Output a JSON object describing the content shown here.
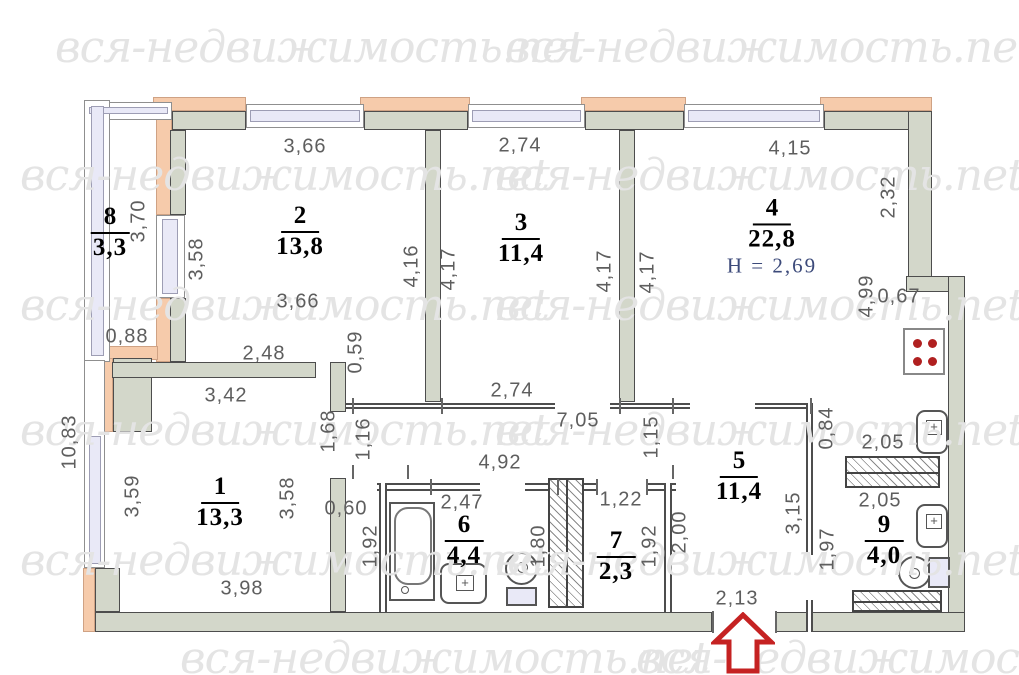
{
  "watermark": {
    "text": "вся-недвижимость.net"
  },
  "colors": {
    "wall_fill": "#d3d7ca",
    "balcony_accent": "#f6cbab",
    "window_glass": "#e9e9f7",
    "dimension_text": "#5e5e5e",
    "room_text": "#000000",
    "ceiling_height_text": "#3c4a7a",
    "entrance_arrow": "#c52222"
  },
  "rooms": [
    {
      "number": "8",
      "area": "3,3",
      "x": 110,
      "y": 232
    },
    {
      "number": "2",
      "area": "13,8",
      "x": 300,
      "y": 231
    },
    {
      "number": "3",
      "area": "11,4",
      "x": 521,
      "y": 238
    },
    {
      "number": "4",
      "area": "22,8",
      "x": 772,
      "y": 236,
      "note": "H = 2,69"
    },
    {
      "number": "1",
      "area": "13,3",
      "x": 220,
      "y": 502
    },
    {
      "number": "6",
      "area": "4,4",
      "x": 464,
      "y": 540
    },
    {
      "number": "7",
      "area": "2,3",
      "x": 616,
      "y": 556
    },
    {
      "number": "5",
      "area": "11,4",
      "x": 739,
      "y": 476
    },
    {
      "number": "9",
      "area": "4,0",
      "x": 884,
      "y": 540
    }
  ],
  "dimensions": [
    {
      "t": "3,66",
      "x": 305,
      "y": 147,
      "v": 0
    },
    {
      "t": "2,74",
      "x": 520,
      "y": 146,
      "v": 0
    },
    {
      "t": "4,15",
      "x": 790,
      "y": 149,
      "v": 0
    },
    {
      "t": "3,70",
      "x": 139,
      "y": 221,
      "v": 1
    },
    {
      "t": "3,58",
      "x": 197,
      "y": 259,
      "v": 1
    },
    {
      "t": "0,88",
      "x": 127,
      "y": 337,
      "v": 0
    },
    {
      "t": "10,83",
      "x": 70,
      "y": 442,
      "v": 1
    },
    {
      "t": "3,66",
      "x": 298,
      "y": 302,
      "v": 0
    },
    {
      "t": "2,48",
      "x": 264,
      "y": 354,
      "v": 0
    },
    {
      "t": "3,42",
      "x": 226,
      "y": 396,
      "v": 0
    },
    {
      "t": "4,16",
      "x": 412,
      "y": 266,
      "v": 1
    },
    {
      "t": "4,17",
      "x": 449,
      "y": 269,
      "v": 1
    },
    {
      "t": "4,17",
      "x": 605,
      "y": 271,
      "v": 1
    },
    {
      "t": "4,17",
      "x": 648,
      "y": 272,
      "v": 1
    },
    {
      "t": "2,32",
      "x": 889,
      "y": 197,
      "v": 1
    },
    {
      "t": "0,67",
      "x": 899,
      "y": 297,
      "v": 0
    },
    {
      "t": "4,99",
      "x": 867,
      "y": 296,
      "v": 1
    },
    {
      "t": "2,74",
      "x": 512,
      "y": 391,
      "v": 0
    },
    {
      "t": "7,05",
      "x": 578,
      "y": 421,
      "v": 0
    },
    {
      "t": "0,59",
      "x": 356,
      "y": 352,
      "v": 1
    },
    {
      "t": "1,16",
      "x": 364,
      "y": 439,
      "v": 1
    },
    {
      "t": "1,68",
      "x": 329,
      "y": 431,
      "v": 1
    },
    {
      "t": "1,15",
      "x": 652,
      "y": 437,
      "v": 1
    },
    {
      "t": "4,92",
      "x": 500,
      "y": 463,
      "v": 0
    },
    {
      "t": "0,60",
      "x": 346,
      "y": 509,
      "v": 0
    },
    {
      "t": "3,59",
      "x": 133,
      "y": 496,
      "v": 1
    },
    {
      "t": "3,58",
      "x": 288,
      "y": 498,
      "v": 1
    },
    {
      "t": "3,98",
      "x": 242,
      "y": 589,
      "v": 0
    },
    {
      "t": "2,47",
      "x": 462,
      "y": 503,
      "v": 0
    },
    {
      "t": "1,92",
      "x": 371,
      "y": 546,
      "v": 1
    },
    {
      "t": "1,80",
      "x": 539,
      "y": 546,
      "v": 1
    },
    {
      "t": "1,22",
      "x": 621,
      "y": 500,
      "v": 0
    },
    {
      "t": "1,92",
      "x": 650,
      "y": 546,
      "v": 1
    },
    {
      "t": "2,00",
      "x": 680,
      "y": 532,
      "v": 1
    },
    {
      "t": "3,15",
      "x": 794,
      "y": 513,
      "v": 1
    },
    {
      "t": "1,97",
      "x": 828,
      "y": 549,
      "v": 1
    },
    {
      "t": "0,84",
      "x": 827,
      "y": 428,
      "v": 1
    },
    {
      "t": "2,05",
      "x": 883,
      "y": 443,
      "v": 0
    },
    {
      "t": "2,05",
      "x": 880,
      "y": 501,
      "v": 0
    },
    {
      "t": "2,13",
      "x": 737,
      "y": 599,
      "v": 0
    }
  ]
}
